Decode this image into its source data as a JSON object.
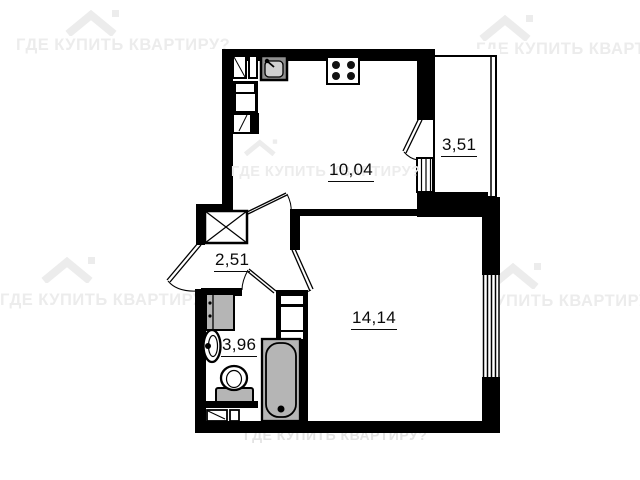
{
  "watermark": {
    "text": "ГДЕ КУПИТЬ КВАРТИРУ?",
    "color": "#ececec"
  },
  "rooms": {
    "kitchen": {
      "label": "10,04"
    },
    "balcony": {
      "label": "3,51"
    },
    "hall": {
      "label": "2,51"
    },
    "bathroom": {
      "label": "3,96"
    },
    "living": {
      "label": "14,14"
    }
  },
  "fixtures": [
    "stove",
    "kitchen-sink",
    "kitchen-cabinet",
    "fridge",
    "wardrobe",
    "washing-machine",
    "bathroom-sink",
    "toilet",
    "bathtub",
    "vent-shaft",
    "entrance-door",
    "window-living-room",
    "window-kitchen-balcony"
  ],
  "colors": {
    "wall": "#000000",
    "fixture_gray": "#b5b5b5",
    "label": "#0a0a0a"
  }
}
